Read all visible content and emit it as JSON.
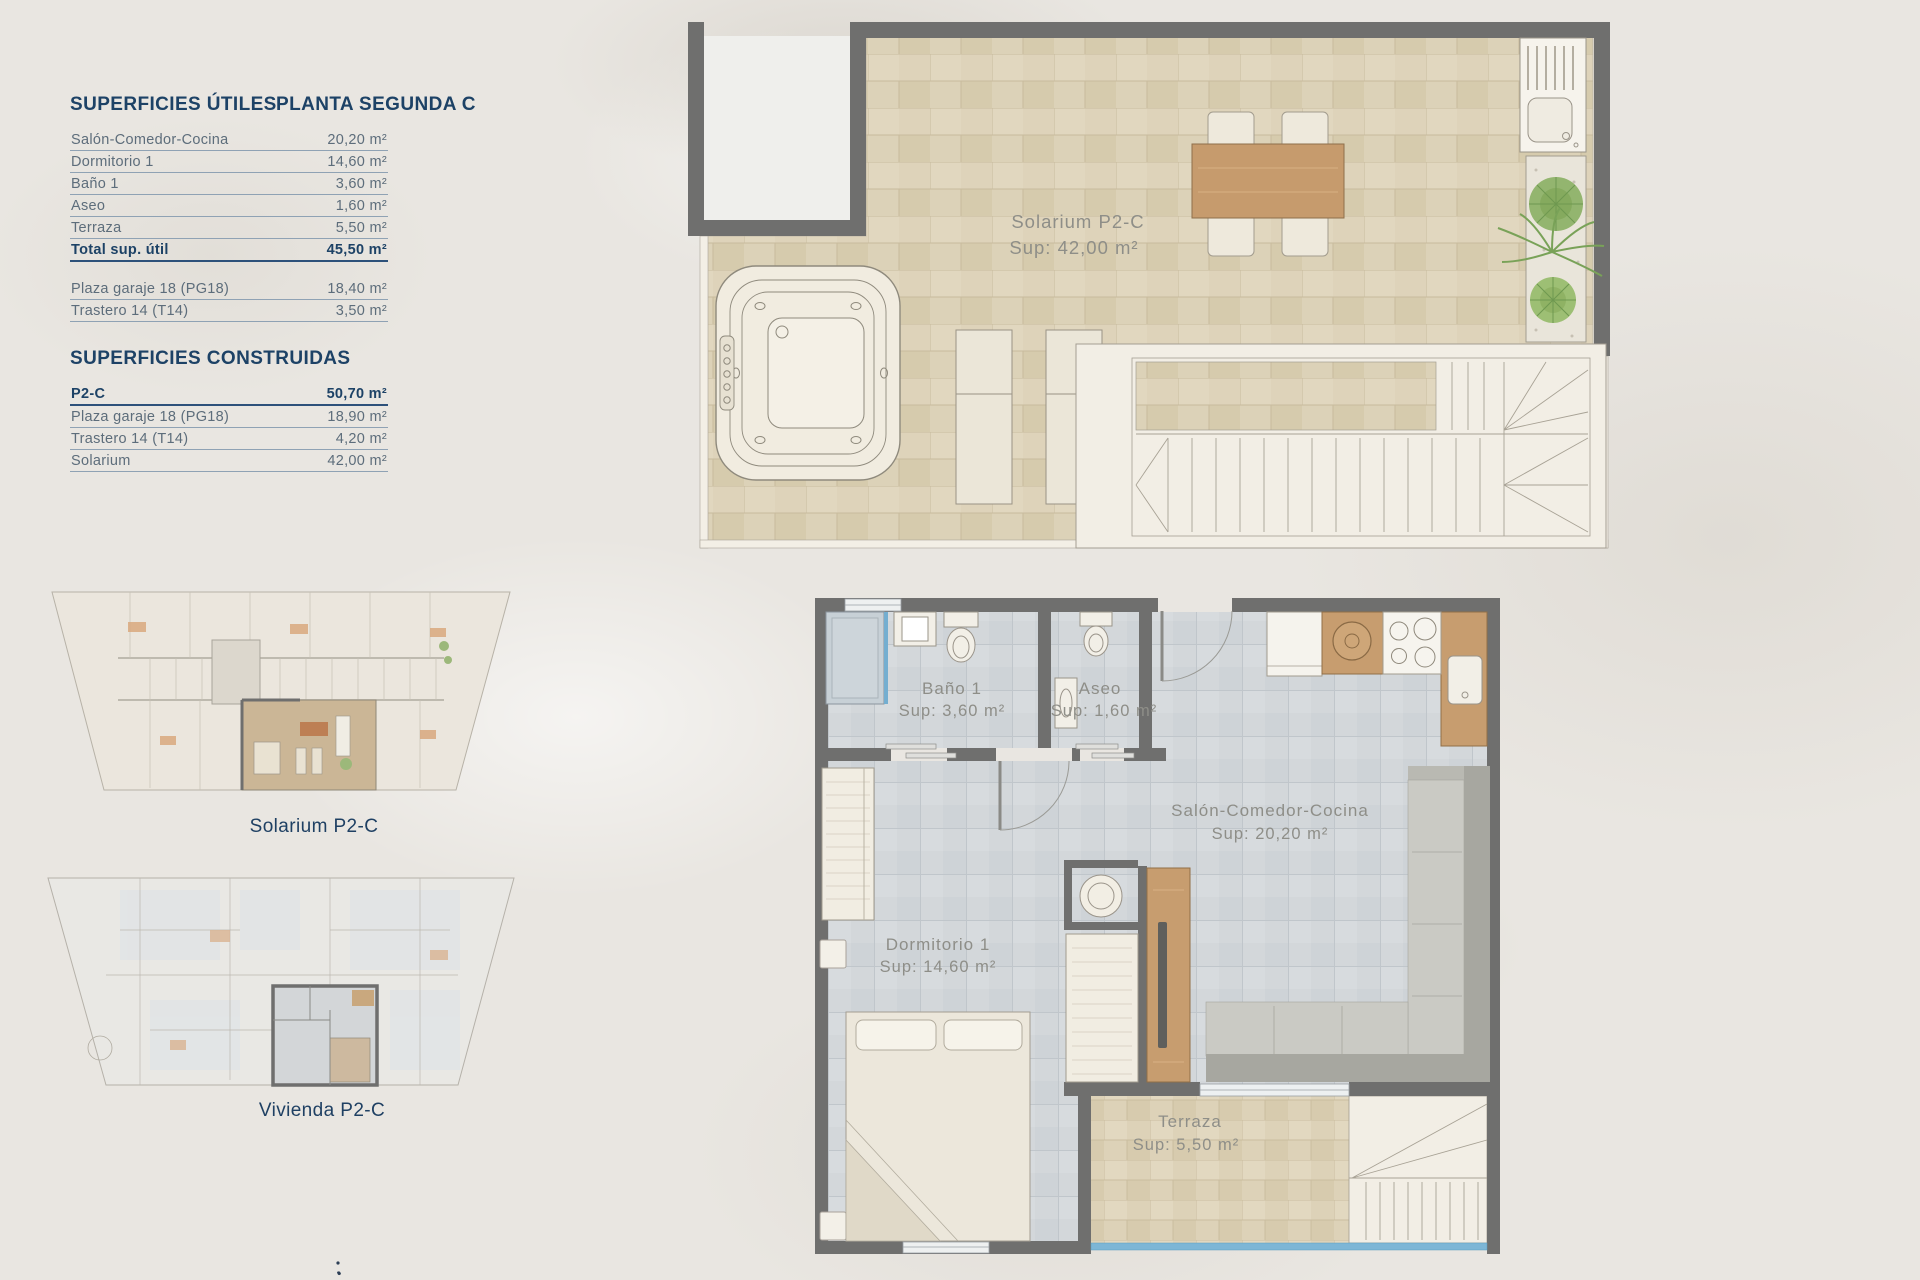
{
  "colors": {
    "accent_navy": "#1d4266",
    "wall_gray": "#6f6f6e",
    "tile_beige": "#dcd2b8",
    "tile_gray": "#d3d7da",
    "wood": "#c79d6f",
    "glazing_blue": "#7db6d6",
    "label_gray": "#8e8e88",
    "background": "#e9e6e1"
  },
  "surfaces_utiles": {
    "title": "SUPERFICIES ÚTILES",
    "subtitle": "PLANTA SEGUNDA C",
    "rows": [
      {
        "label": "Salón-Comedor-Cocina",
        "value": "20,20 m²"
      },
      {
        "label": "Dormitorio 1",
        "value": "14,60 m²"
      },
      {
        "label": "Baño 1",
        "value": "3,60 m²"
      },
      {
        "label": "Aseo",
        "value": "1,60 m²"
      },
      {
        "label": "Terraza",
        "value": "5,50 m²"
      }
    ],
    "total": {
      "label": "Total sup. útil",
      "value": "45,50 m²"
    },
    "extras": [
      {
        "label": "Plaza garaje 18 (PG18)",
        "value": "18,40 m²"
      },
      {
        "label": "Trastero 14 (T14)",
        "value": "3,50 m²"
      }
    ]
  },
  "surfaces_construidas": {
    "title": "SUPERFICIES CONSTRUIDAS",
    "rows": [
      {
        "label": "P2-C",
        "value": "50,70 m²"
      },
      {
        "label": "Plaza garaje 18 (PG18)",
        "value": "18,90 m²"
      },
      {
        "label": "Trastero 14 (T14)",
        "value": "4,20 m²"
      },
      {
        "label": "Solarium",
        "value": "42,00 m²"
      }
    ]
  },
  "solarium_plan": {
    "name": "Solarium P2-C",
    "sup": "Sup: 42,00 m²"
  },
  "apartment_plan": {
    "rooms": [
      {
        "name": "Baño 1",
        "sup": "Sup: 3,60 m²"
      },
      {
        "name": "Aseo",
        "sup": "Sup: 1,60 m²"
      },
      {
        "name": "Salón-Comedor-Cocina",
        "sup": "Sup: 20,20 m²"
      },
      {
        "name": "Dormitorio 1",
        "sup": "Sup: 14,60 m²"
      },
      {
        "name": "Terraza",
        "sup": "Sup: 5,50 m²"
      }
    ]
  },
  "mini_plans": [
    {
      "caption": "Solarium P2-C"
    },
    {
      "caption": "Vivienda P2-C"
    }
  ]
}
